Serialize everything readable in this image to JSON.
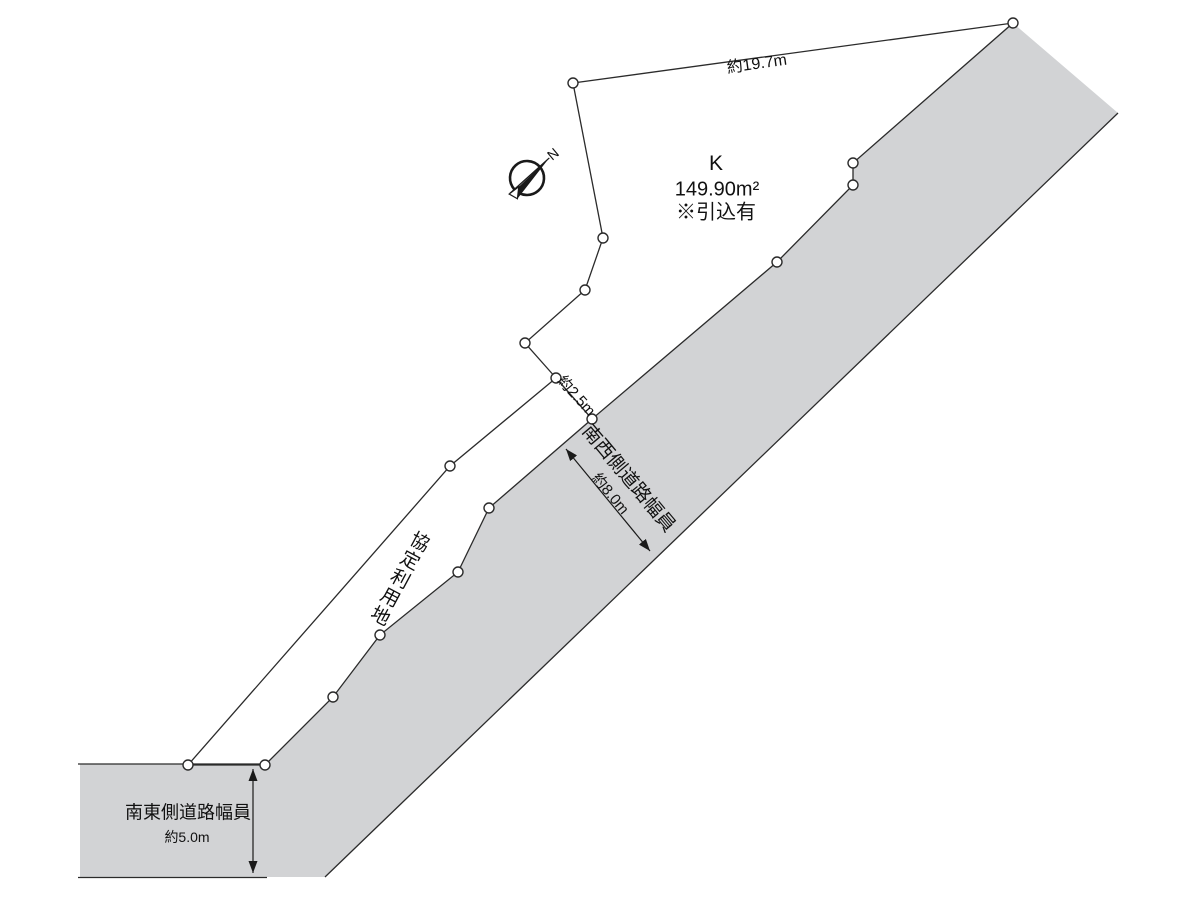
{
  "diagram": {
    "plot": {
      "name": "K",
      "area": "149.90m²",
      "note": "※引込有"
    },
    "dimensions": {
      "top_edge_length": "約19.7m",
      "access_width": "約2.5m",
      "southwest_road_width": "約8.0m",
      "southeast_road_width": "約5.0m"
    },
    "labels": {
      "southwest_road": "南西側道路幅員",
      "southeast_road": "南東側道路幅員",
      "agreement_land": "協定利用地",
      "compass_north": "N"
    },
    "colors": {
      "plot_fill": "#dbebd6",
      "road_fill": "#d2d3d5",
      "line": "#2b2b2b"
    }
  }
}
